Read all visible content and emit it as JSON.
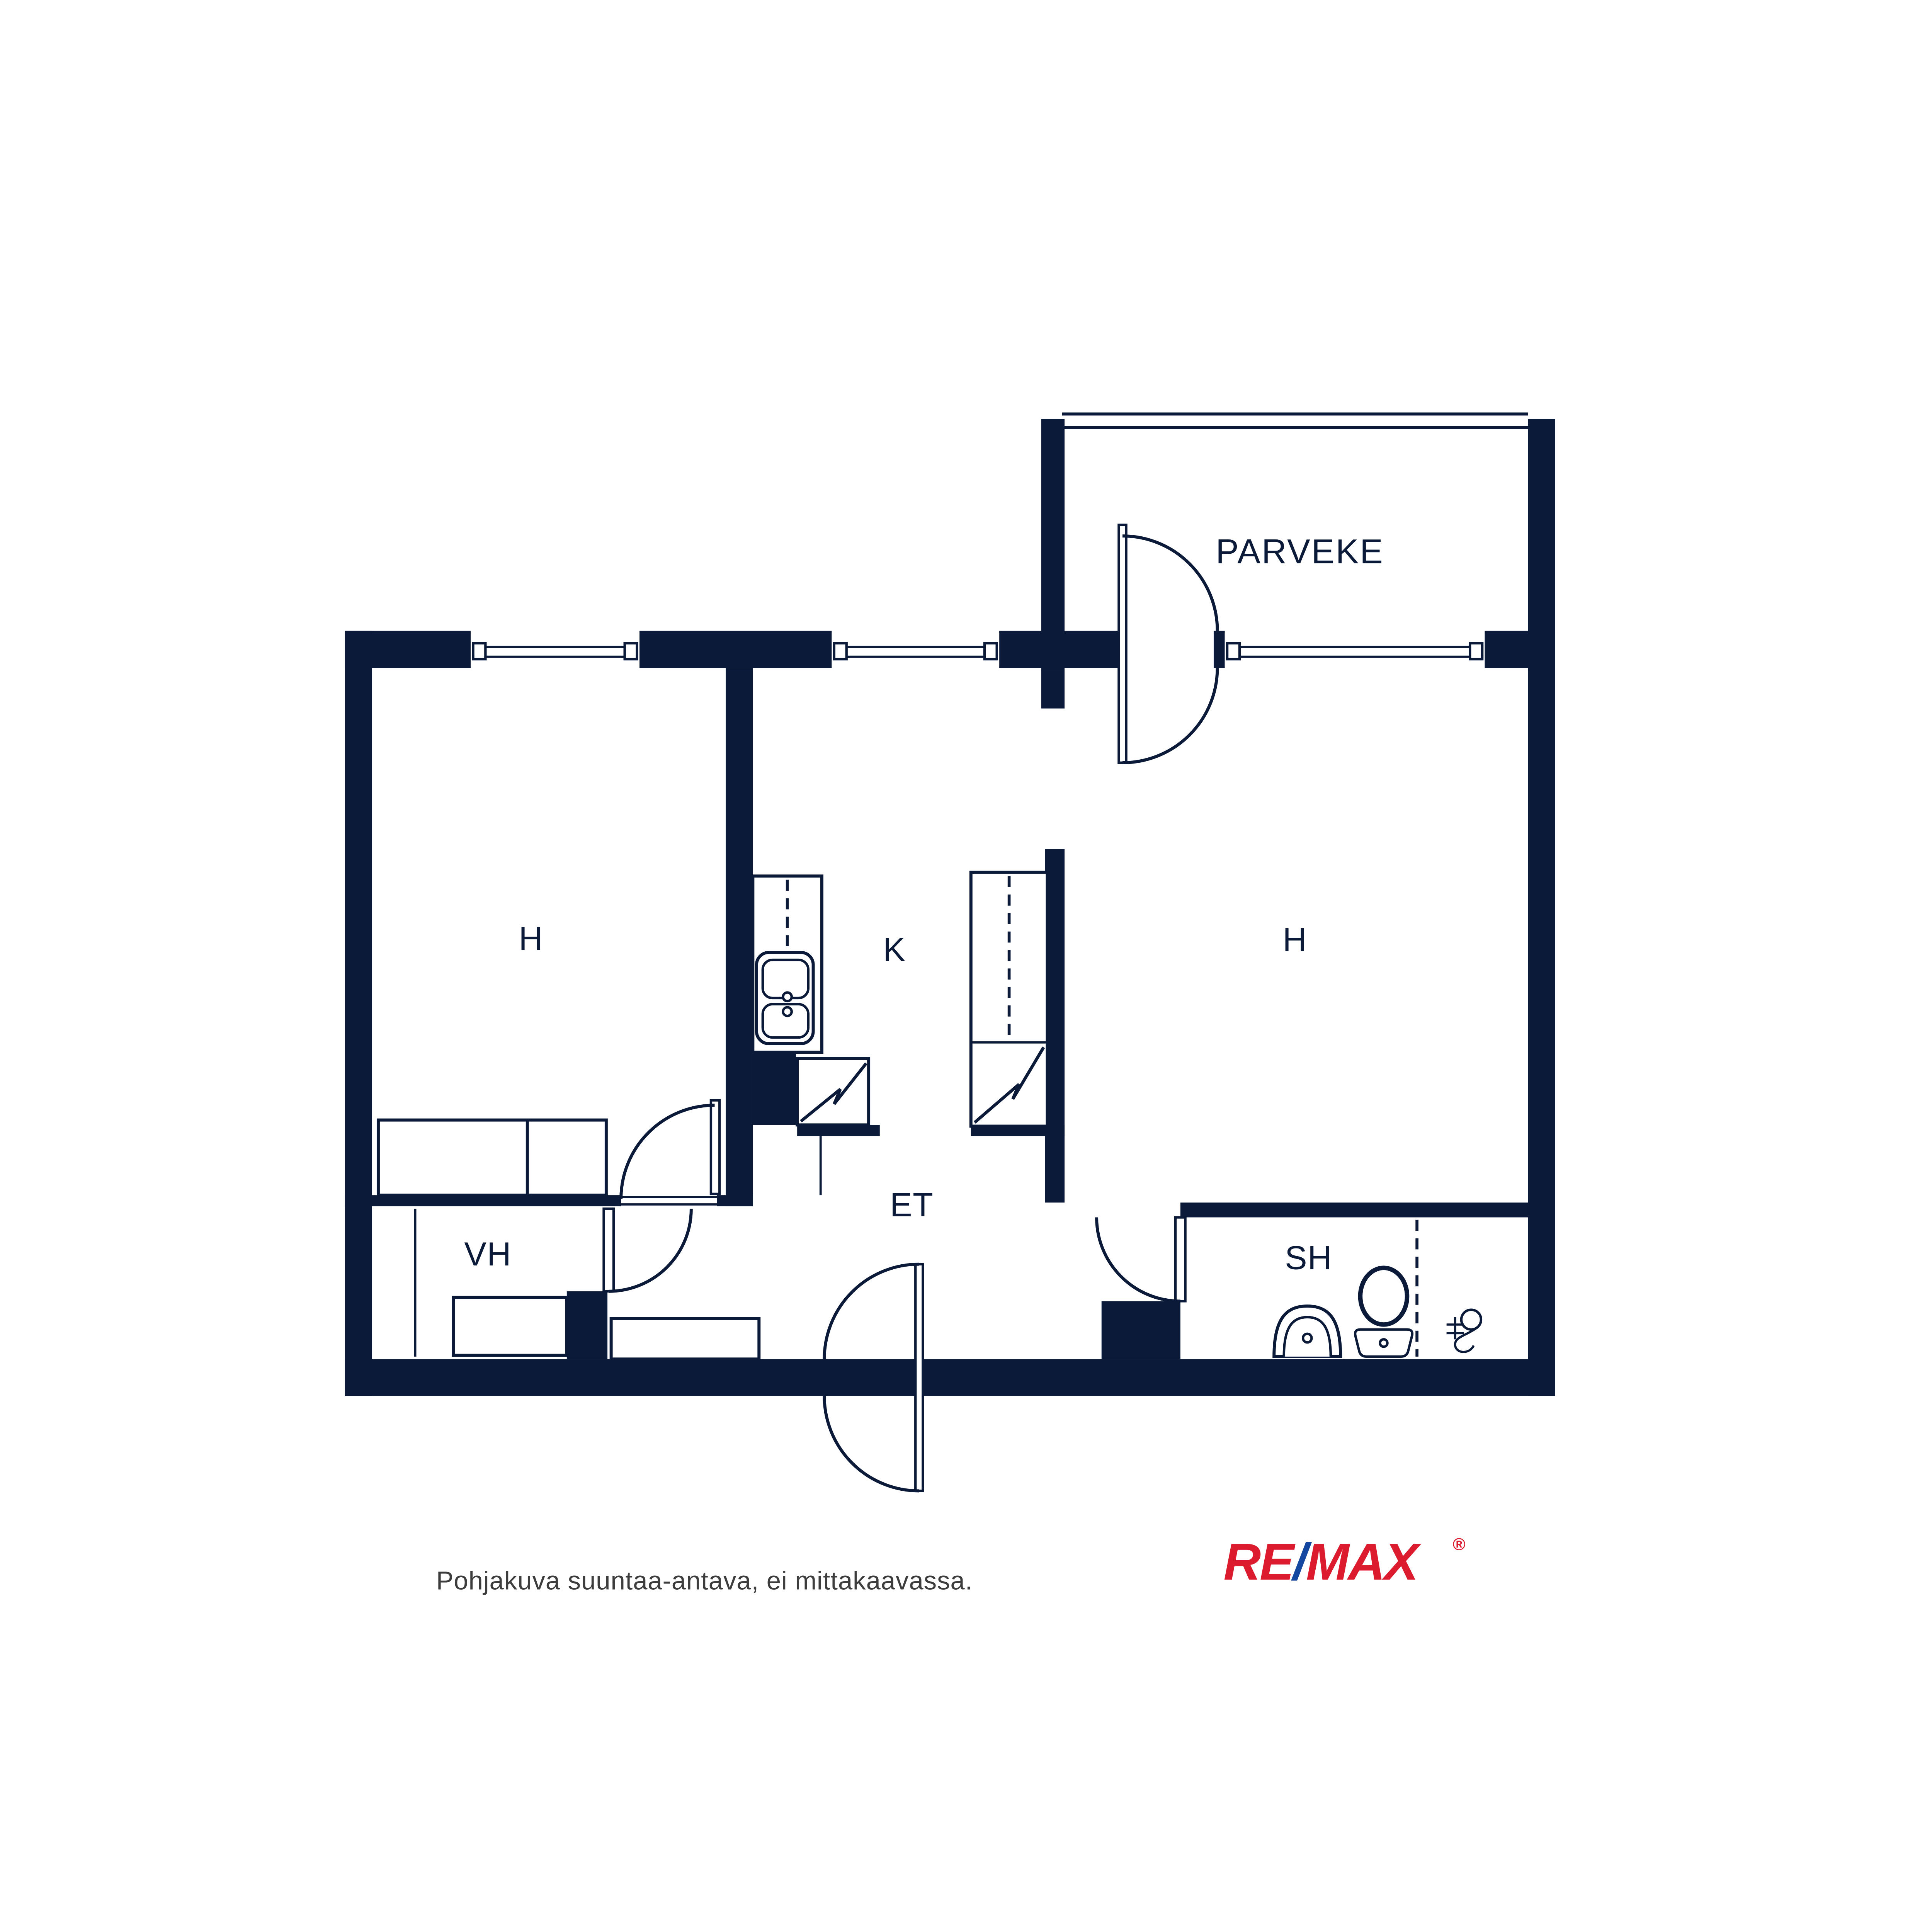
{
  "colors": {
    "navy": "#0a1a38",
    "footnote": "#3d3d3d",
    "remax_red": "#dc1c2e",
    "remax_blue": "#1447a0",
    "background": "#ffffff"
  },
  "plan": {
    "rooms": [
      {
        "id": "parveke",
        "label": "PARVEKE"
      },
      {
        "id": "h-left",
        "label": "H"
      },
      {
        "id": "kitchen",
        "label": "K"
      },
      {
        "id": "h-right",
        "label": "H"
      },
      {
        "id": "et",
        "label": "ET"
      },
      {
        "id": "vh",
        "label": "VH"
      },
      {
        "id": "sh",
        "label": "SH"
      }
    ],
    "fixtures": [
      "kitchen-sink",
      "stove",
      "tall-cabinet",
      "bed",
      "vh-shelf",
      "hallway-cabinet",
      "toilet",
      "washbasin",
      "floor-drain",
      "window",
      "door-swing",
      "balcony-railing"
    ]
  },
  "footer": {
    "disclaimer": "Pohjakuva suuntaa-antava, ei mittakaavassa."
  },
  "logo": {
    "re": "RE",
    "slash": "/",
    "max": "MAX",
    "registered": "®"
  }
}
